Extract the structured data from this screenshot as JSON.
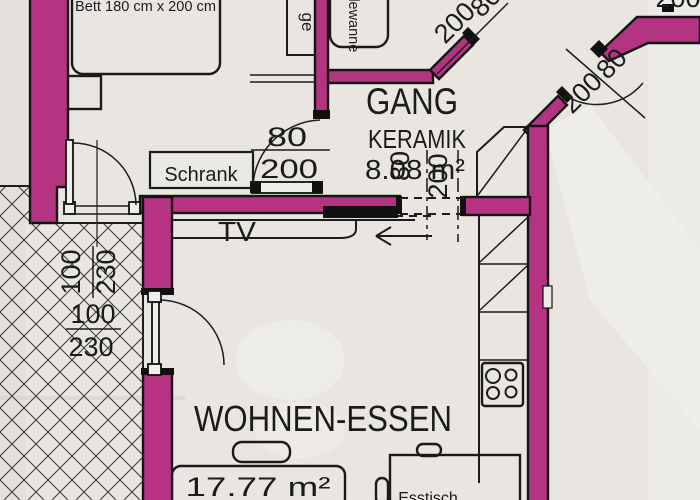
{
  "plan": {
    "bedroom": {
      "bed_label": "Bett 180 cm x 200 cm",
      "shelf_label": "ge",
      "wardrobe_label": "Schrank"
    },
    "bathroom": {
      "tub_label": "Badewanne"
    },
    "gang": {
      "name": "GANG",
      "finish": "KERAMIK",
      "area": "8.08 m²"
    },
    "living": {
      "name": "WOHNEN-ESSEN",
      "area": "17.77 m²",
      "tv_label": "TV",
      "table_label": "Esstisch"
    },
    "dims": {
      "gang_door": {
        "num": "80",
        "den": "200"
      },
      "overlay_door": {
        "num": "80",
        "den": "200"
      },
      "hall_door": {
        "num": "80",
        "den": "200"
      },
      "entry_door": {
        "num": "80",
        "den": "200"
      },
      "left_opening_rotated": {
        "num": "100",
        "den": "230"
      },
      "left_opening": {
        "num": "100",
        "den": "230"
      },
      "edge_partial": "200"
    },
    "colors": {
      "wall": "#b53383",
      "paper": "#e9e6e2",
      "line": "#1c1c1c"
    }
  }
}
